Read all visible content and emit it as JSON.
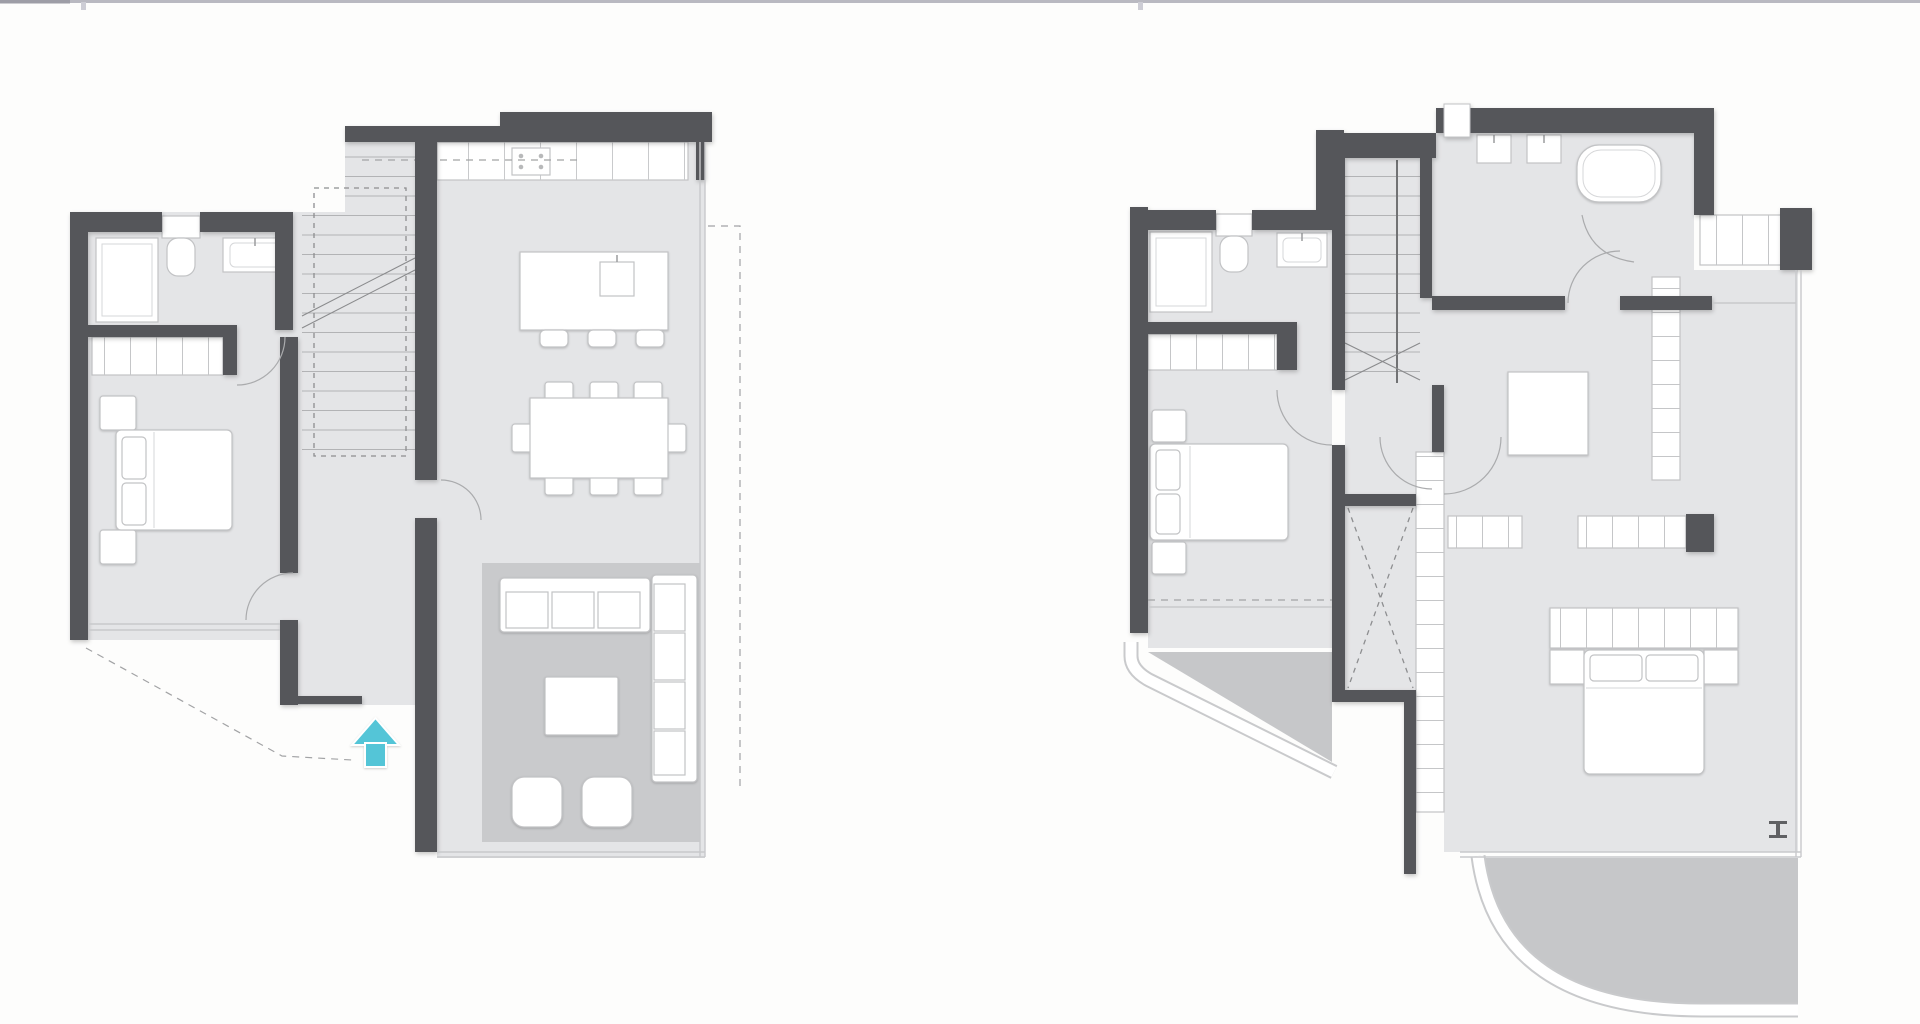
{
  "page": {
    "background": "#fdfdfc",
    "top_border": {
      "color": "#b9b9c1",
      "left_accent": "#9d9da6",
      "tick_color": "#cdcdd5"
    }
  },
  "palette": {
    "wall": "#55565a",
    "floor": "#e4e5e7",
    "rug": "#c9cacc",
    "terrace": "#c6c7c9",
    "furniture_fill": "#ffffff",
    "furniture_stroke": "#c2c3c5",
    "detail_line": "#bcbdbf",
    "dash": "#a2a3a5",
    "glass": "#c8c9cb",
    "arrow": "#54c5d7",
    "marker": "#606164"
  },
  "plans": [
    {
      "id": "ground-floor",
      "rooms": [
        "bathroom",
        "bedroom",
        "hallway",
        "staircase",
        "kitchen",
        "dining-area",
        "living-area",
        "entrance"
      ],
      "furniture_icons": [
        "shower",
        "toilet",
        "washbasin",
        "wardrobe",
        "double-bed",
        "nightstand",
        "kitchen-counter",
        "cooktop",
        "kitchen-island",
        "bar-stool",
        "dining-table",
        "dining-chair",
        "sofa",
        "chaise-sofa",
        "coffee-table",
        "pouf",
        "rug"
      ],
      "icons": [
        {
          "name": "entrance-arrow",
          "shape": "arrow-up",
          "color": "#54c5d7"
        }
      ]
    },
    {
      "id": "first-floor",
      "rooms": [
        "bedroom-2",
        "ensuite-zone",
        "staircase",
        "hallway",
        "void",
        "family-bathroom",
        "master-bedroom",
        "dressing-area",
        "terrace-small",
        "terrace-large"
      ],
      "furniture_icons": [
        "shower",
        "toilet",
        "washbasin",
        "wardrobe",
        "double-bed",
        "nightstand",
        "double-washbasin",
        "bathtub",
        "walk-in-closet",
        "closet-row",
        "side-table",
        "headboard-console"
      ],
      "icons": [
        {
          "name": "section-marker",
          "shape": "i-beam",
          "color": "#606164"
        }
      ]
    }
  ]
}
